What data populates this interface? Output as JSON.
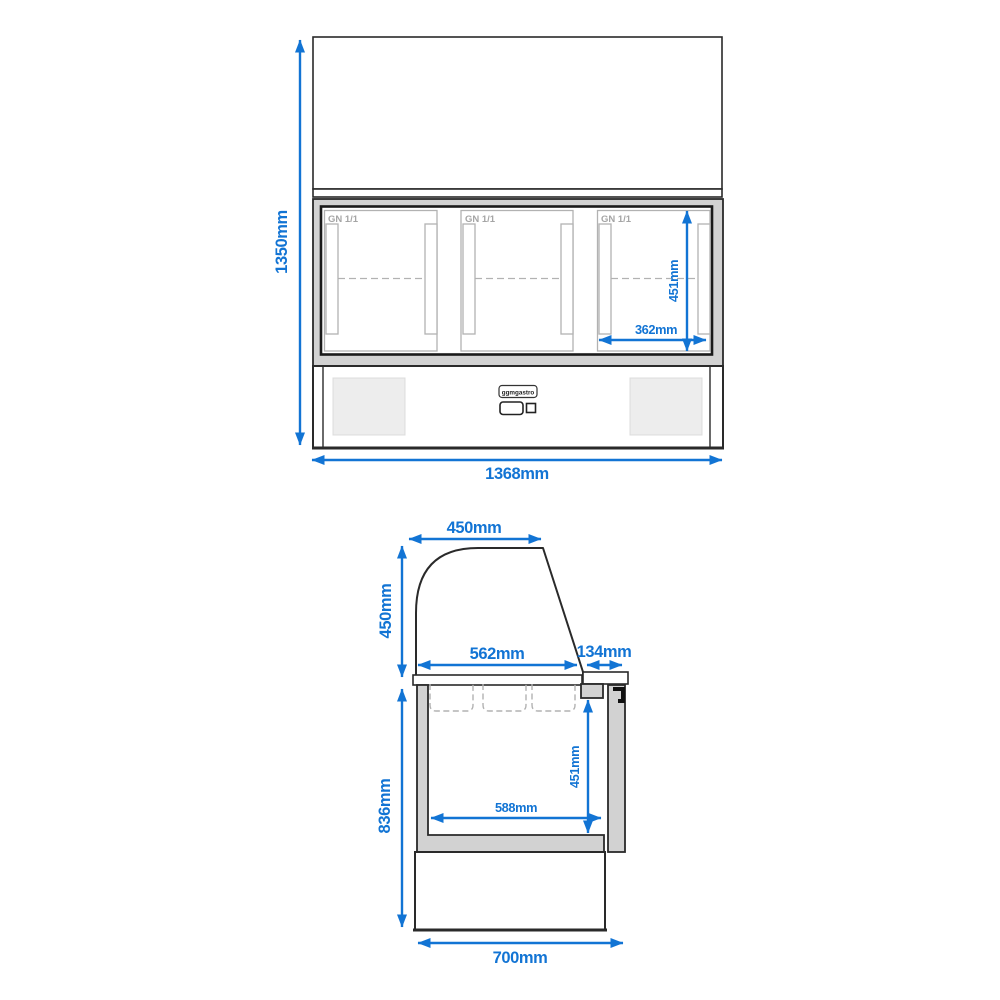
{
  "front_view": {
    "compartment_labels": [
      "GN 1/1",
      "GN 1/1",
      "GN 1/1"
    ],
    "logo_text": "ggmgastro",
    "dimensions": {
      "overall_height": "1350mm",
      "overall_width": "1368mm",
      "inner_height": "451mm",
      "inner_width": "362mm"
    }
  },
  "side_view": {
    "dimensions": {
      "glass_depth": "450mm",
      "glass_height": "450mm",
      "top_depth": "562mm",
      "board_depth": "134mm",
      "body_height": "836mm",
      "well_height": "451mm",
      "well_depth": "588mm",
      "overall_depth": "700mm"
    }
  },
  "colors": {
    "dimension_blue": "#1274d4",
    "outline_dark": "#2a2a2a",
    "frame_gray": "#d2d2d2",
    "door_gray": "#b2b2b2",
    "label_gray": "#a5a5a5",
    "vent_gray": "#ededed"
  }
}
